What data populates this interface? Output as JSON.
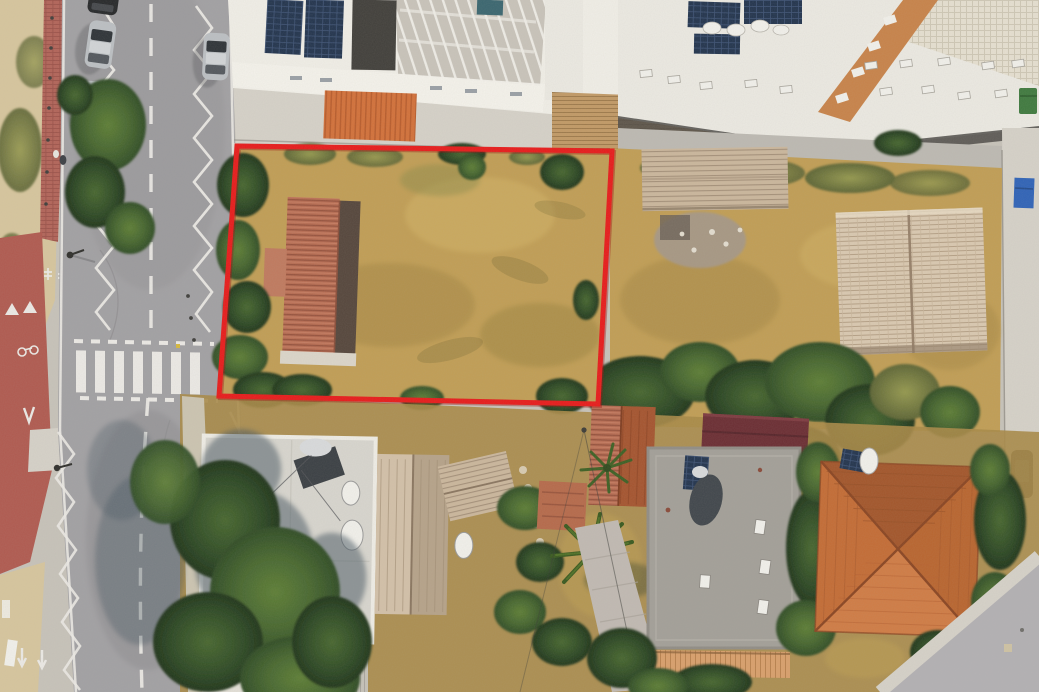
{
  "colors": {
    "boundary_red": "#e81b1b",
    "boundary_red_dark": "#9e0f0f",
    "asphalt": "#a2a1a4",
    "asphalt_light": "#b3b1b4",
    "asphalt_dark": "#8d8c90",
    "road_marking": "#eceae6",
    "bike_lane_red": "#b05a50",
    "brick_sidewalk": "#b26459",
    "concrete_light": "#d6d2c9",
    "concrete_mid": "#c7c3ba",
    "sand": "#d7c69e",
    "grass_dry_gold": "#c19e55",
    "grass_dry_dark": "#a98a47",
    "grass_pale": "#cfae62",
    "olive_light": "#95994f",
    "olive_dark": "#5d6535",
    "tree_light": "#5d7e35",
    "tree_mid": "#47672f",
    "tree_dark": "#2f4c26",
    "tree_deepest": "#20351b",
    "tree_shadow": "#43525f",
    "roof_terracotta": "#b76c52",
    "roof_terracotta_line": "#96523d",
    "roof_terracotta_shade": "#55463c",
    "roof_orange": "#c46c35",
    "roof_orange_light": "#d07c45",
    "roof_orange_dark": "#a3562b",
    "roof_ridge_orange": "#8a4522",
    "roof_weathered": "#cbb79d",
    "roof_weathered_line": "#a5917a",
    "roof_pale": "#dac9b1",
    "roof_pale_line": "#b5a086",
    "roof_maroon": "#6b2d33",
    "roof_maroon_dark": "#57242a",
    "roof_beige": "#e6e0d1",
    "roof_beige_line": "#cfc8b6",
    "roof_gray_flat": "#a3a099",
    "roof_white_flat": "#d8d6cf",
    "roof_corrugated": "#c6c2b9",
    "roof_corrugated_line": "#a9a59e",
    "wall_white": "#f1efe8",
    "roof_white": "#eceae3",
    "roof_dark": "#413f3b",
    "solar_panel": "#22344e",
    "solar_grid": "#3d5274",
    "shadow_band": "#4c4a47",
    "awning_orange": "#d3713a",
    "awning_orange_dark": "#b85c2c",
    "walkway_orange": "#c8834a",
    "deck_wood": "#c29a66",
    "deck_wood_line": "#9e7a4b",
    "fence_peach": "#d9a06c",
    "fence_peach_line": "#b9824e",
    "drive_mauve": "#c1bab3",
    "car_silver": "#bcc0c4",
    "car_silver_roof": "#d2d5d8",
    "car_glass": "#2e3338",
    "car_black": "#26282a",
    "car_dark": "#3c4043",
    "dumpster_green": "#3f7a3f",
    "dumpster_blue": "#2f63b8",
    "teal_object": "#3a6670",
    "white_object": "#f2f1ec",
    "rubble": "#a79884",
    "equipment_dark": "#3a3f44",
    "yellow_mark": "#d8b93c"
  },
  "boundary": {
    "points": "237,146 612,151 598,404 219,396",
    "stroke_width": "5"
  },
  "scene": {
    "type": "aerial-drone-photograph",
    "subject": "vacant land plot outlined in red",
    "parked_cars_left": 3,
    "crosswalk_stripes": 7,
    "objects": [
      "two-lane road with zigzag markings and zebra crosswalk",
      "red cycle lane and brick sidewalk",
      "vacant plot of dry golden grass with terracotta gable-roof building",
      "ruined outbuilding and weathered-tile old house east of plot",
      "white apartment blocks with rooftop solar panels and AC units",
      "white flat-roof house with tree shadows",
      "gray flat-roof house with solar water heaters",
      "orange hipped-roof house at street corner",
      "palm trees and pine trees",
      "green and blue dumpsters"
    ]
  }
}
